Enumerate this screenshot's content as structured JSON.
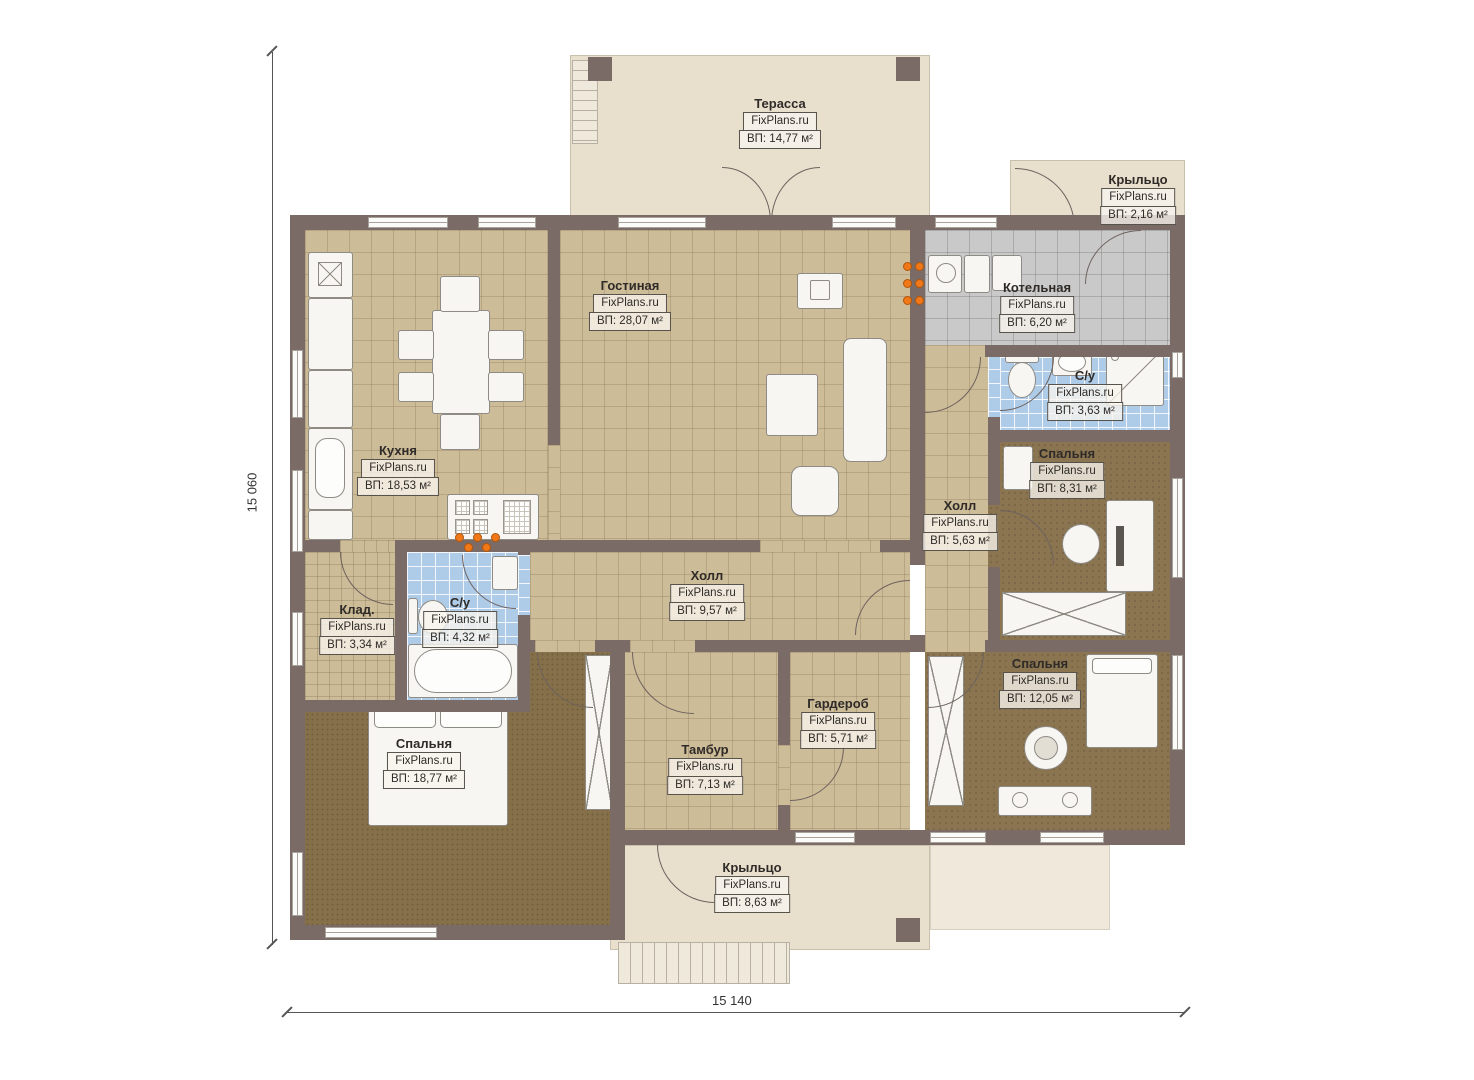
{
  "brand": "FixPlans.ru",
  "dimension_labels": {
    "vertical": "15 060",
    "horizontal": "15 140"
  },
  "rooms": [
    {
      "name": "Терасса",
      "area": "ВП: 14,77 м²"
    },
    {
      "name": "Крыльцо",
      "area": "ВП: 2,16 м²"
    },
    {
      "name": "Гостиная",
      "area": "ВП: 28,07 м²"
    },
    {
      "name": "Котельная",
      "area": "ВП: 6,20 м²"
    },
    {
      "name": "С/у",
      "area": "ВП: 3,63 м²"
    },
    {
      "name": "Кухня",
      "area": "ВП: 18,53 м²"
    },
    {
      "name": "Спальня",
      "area": "ВП: 8,31 м²"
    },
    {
      "name": "Холл",
      "area": "ВП: 5,63 м²"
    },
    {
      "name": "Холл",
      "area": "ВП: 9,57 м²"
    },
    {
      "name": "Клад.",
      "area": "ВП: 3,34 м²"
    },
    {
      "name": "С/у",
      "area": "ВП: 4,32 м²"
    },
    {
      "name": "Гардероб",
      "area": "ВП: 5,71 м²"
    },
    {
      "name": "Спальня",
      "area": "ВП: 12,05 м²"
    },
    {
      "name": "Спальня",
      "area": "ВП: 18,77 м²"
    },
    {
      "name": "Тамбур",
      "area": "ВП: 7,13 м²"
    },
    {
      "name": "Крыльцо",
      "area": "ВП: 8,63 м²"
    }
  ],
  "colors": {
    "wall": "#7b6b67",
    "floor_tile_tan": "#cdbc98",
    "floor_carpet_brown": "#8b7550",
    "floor_tile_blue": "#aecbe8",
    "floor_tile_gray": "#c9c9c9",
    "terrace_beige": "#e9dfcd",
    "burner_orange": "#f07818"
  }
}
